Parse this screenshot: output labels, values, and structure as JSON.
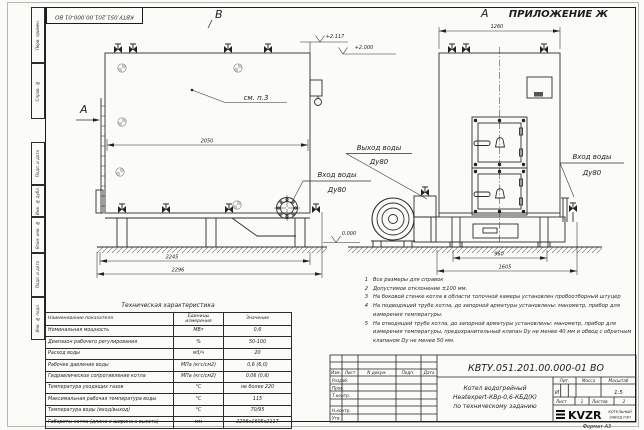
{
  "frame": {
    "margin_labels_top": [
      "Перв. примен.",
      "Справ. №"
    ],
    "margin_labels_bottom": [
      "Подп. и дата",
      "Инв. № дубл.",
      "Взам. инв. №",
      "Подп. и дата",
      "Инв. № подл."
    ],
    "format_label": "Формат А3"
  },
  "drawing": {
    "appendix_label": "ПРИЛОЖЕНИЕ Ж",
    "view_a_label": "А",
    "view_b_label": "В",
    "section_a_label": "А",
    "see_note": "см. п.3",
    "elevations": {
      "top": "+2.117",
      "mid": "+2.000",
      "ground": "0.000"
    },
    "labels": {
      "water_outlet": "Выход воды",
      "water_outlet_dn": "Ду80",
      "water_inlet_side": "Вход воды",
      "water_inlet_side_dn": "Ду80",
      "water_inlet_front": "Вход воды",
      "water_inlet_front_dn": "Ду80"
    },
    "dimensions": {
      "side_width_top": "2050",
      "side_base": "2245",
      "side_overall": "2296",
      "front_top": "1260",
      "front_base": "960",
      "front_overall": "1605"
    }
  },
  "tech_table": {
    "title": "Техническая характеристика",
    "headers": [
      "Наименование показателя",
      "Единицы измерения",
      "Значение"
    ],
    "rows": [
      [
        "Номинальная мощность",
        "МВт",
        "0,6"
      ],
      [
        "Диапазон рабочего регулирования",
        "%",
        "50-100"
      ],
      [
        "Расход воды",
        "м3/ч",
        "20"
      ],
      [
        "Рабочее давление воды",
        "МПа (кгс/см2)",
        "0,6 (6,0)"
      ],
      [
        "Гидравлическое сопротивление котла",
        "МПа (кгс/см2)",
        "0,06 (0,6)"
      ],
      [
        "Температура уходящих газов",
        "°С",
        "не более 220"
      ],
      [
        "Максимальная рабочая температура воды",
        "°С",
        "115"
      ],
      [
        "Температура воды (вход/выход)",
        "°С",
        "70/95"
      ],
      [
        "Габариты котла (длина х ширина х высота)",
        "мм",
        "2296х1605х2117"
      ]
    ]
  },
  "notes": {
    "items": [
      {
        "num": "1",
        "text": "Все размеры для справок"
      },
      {
        "num": "2",
        "text": "Допустимое отклонение ±100 мм."
      },
      {
        "num": "3",
        "text": "На боковой стенке котла в области топочной камеры установлен пробоотборный штуцер"
      },
      {
        "num": "4",
        "text": "На подводящей трубе котла, до запорной арматуры установлены: манометр, прибор для измерения температуры."
      },
      {
        "num": "5",
        "text": "На отводящей трубе котла, до запорной арматуры установлены: манометр, прибор для измерения температуры, предохранительный клапан Dу не менее 40 мм и обвод с обратным клапаном Dу не менее 50 мм."
      }
    ]
  },
  "title_block": {
    "doc_number": "КВТУ.051.201.00.000-01 ВО",
    "name_line1": "Котел водогрейный",
    "name_line2": "Heatexpert-КВр-0,6-КБД(К)",
    "name_line3": "по техническому заданию",
    "header_row": [
      "Изм.",
      "Лист",
      "N докум.",
      "Подп.",
      "Дата"
    ],
    "sig_labels": [
      "Разраб.",
      "Пров.",
      "Т.контр.",
      "Н.контр.",
      "Утв."
    ],
    "lit_header": "Лит.",
    "lit_value": "И",
    "mass_header": "Масса",
    "scale_header": "Масштаб",
    "scale_value": "1:5",
    "sheet_label": "Лист",
    "sheet_value": "1",
    "sheets_label": "Листов",
    "sheets_value": "2",
    "company_logo": "KVZR",
    "company_name1": "КОТЕЛЬНЫЙ",
    "company_name2": "ЗАВОД РЭП"
  }
}
